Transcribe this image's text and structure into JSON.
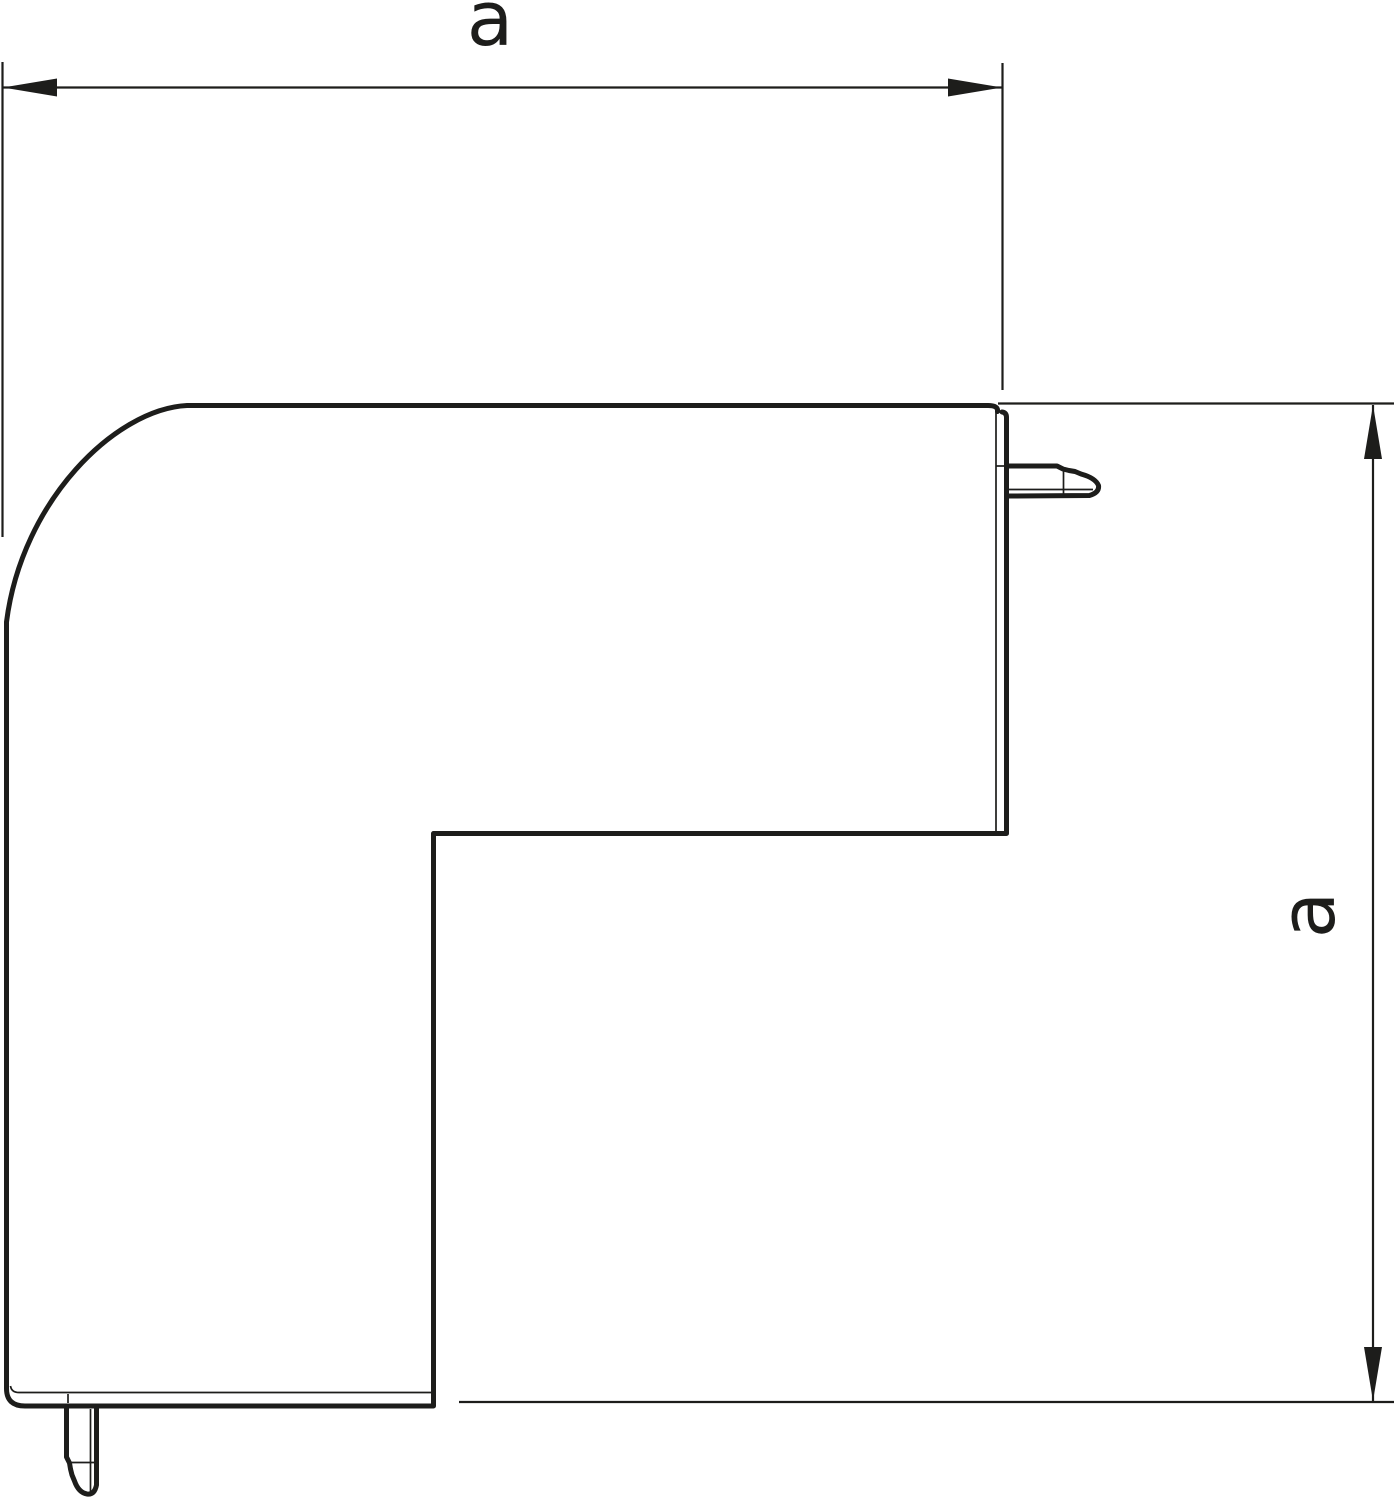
{
  "drawing": {
    "dimension_labels": {
      "horizontal": "a",
      "vertical": "a"
    },
    "colors": {
      "line_color": "#1d1d1b",
      "background": "#ffffff"
    }
  }
}
